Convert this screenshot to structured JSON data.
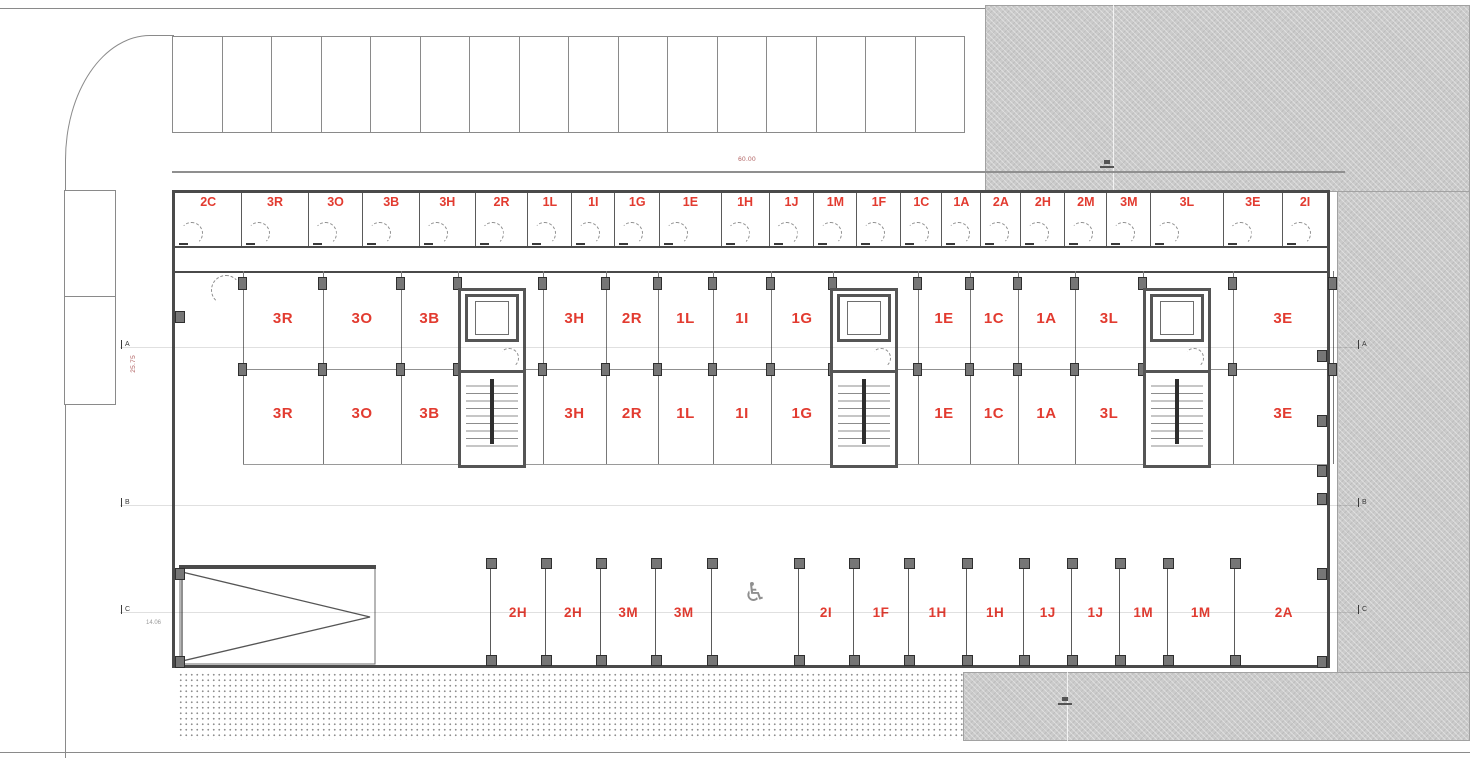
{
  "plan": {
    "title": "storage-and-parking-floor-plan",
    "colors": {
      "unit_label": "#e23b30",
      "wall": "#4a4a4a",
      "adjacent_fill": "#cbcbcb",
      "dimension_red": "#b06060"
    },
    "dimensions": {
      "top_width": "60.00",
      "left_height": "25.75",
      "left_lower": "14.06"
    },
    "grid_rows": [
      "A",
      "B",
      "C"
    ],
    "surface_parking_space_count": 16,
    "top_units": [
      {
        "label": "2C",
        "w": 68
      },
      {
        "label": "3R",
        "w": 67
      },
      {
        "label": "3O",
        "w": 55
      },
      {
        "label": "3B",
        "w": 57
      },
      {
        "label": "3H",
        "w": 56
      },
      {
        "label": "2R",
        "w": 53
      },
      {
        "label": "1L",
        "w": 44
      },
      {
        "label": "1I",
        "w": 43
      },
      {
        "label": "1G",
        "w": 45
      },
      {
        "label": "1E",
        "w": 62
      },
      {
        "label": "1H",
        "w": 48
      },
      {
        "label": "1J",
        "w": 45
      },
      {
        "label": "1M",
        "w": 43
      },
      {
        "label": "1F",
        "w": 44
      },
      {
        "label": "1C",
        "w": 41
      },
      {
        "label": "1A",
        "w": 39
      },
      {
        "label": "2A",
        "w": 40
      },
      {
        "label": "2H",
        "w": 44
      },
      {
        "label": "2M",
        "w": 42
      },
      {
        "label": "3M",
        "w": 44
      },
      {
        "label": "3L",
        "w": 73
      },
      {
        "label": "3E",
        "w": 60
      },
      {
        "label": "2I",
        "w": 45
      }
    ],
    "main_unit_rows": [
      "A",
      "B"
    ],
    "main_units": [
      {
        "label": "3R",
        "x": 240,
        "w": 80
      },
      {
        "label": "3O",
        "x": 320,
        "w": 78
      },
      {
        "label": "3B",
        "x": 398,
        "w": 57
      },
      {
        "label": "3H",
        "x": 540,
        "w": 63
      },
      {
        "label": "2R",
        "x": 603,
        "w": 52
      },
      {
        "label": "1L",
        "x": 655,
        "w": 55
      },
      {
        "label": "1I",
        "x": 710,
        "w": 58
      },
      {
        "label": "1G",
        "x": 768,
        "w": 62
      },
      {
        "label": "1E",
        "x": 915,
        "w": 52
      },
      {
        "label": "1C",
        "x": 967,
        "w": 48
      },
      {
        "label": "1A",
        "x": 1015,
        "w": 57
      },
      {
        "label": "3L",
        "x": 1072,
        "w": 68
      },
      {
        "label": "3E",
        "x": 1230,
        "w": 100
      }
    ],
    "bottom_stalls": [
      {
        "label": "2H",
        "w": 55
      },
      {
        "label": "2H",
        "w": 55
      },
      {
        "label": "3M",
        "w": 55
      },
      {
        "label": "3M",
        "w": 56
      },
      {
        "label": "",
        "w": 87,
        "accessible": true,
        "icon": "wheelchair-symbol",
        "glyph": "♿"
      },
      {
        "label": "2I",
        "w": 55
      },
      {
        "label": "1F",
        "w": 55
      },
      {
        "label": "1H",
        "w": 58
      },
      {
        "label": "1H",
        "w": 57
      },
      {
        "label": "1J",
        "w": 48
      },
      {
        "label": "1J",
        "w": 47
      },
      {
        "label": "1M",
        "w": 48
      },
      {
        "label": "1M",
        "w": 67
      },
      {
        "label": "2A",
        "w": 100
      }
    ],
    "stair_core_count": 3
  }
}
